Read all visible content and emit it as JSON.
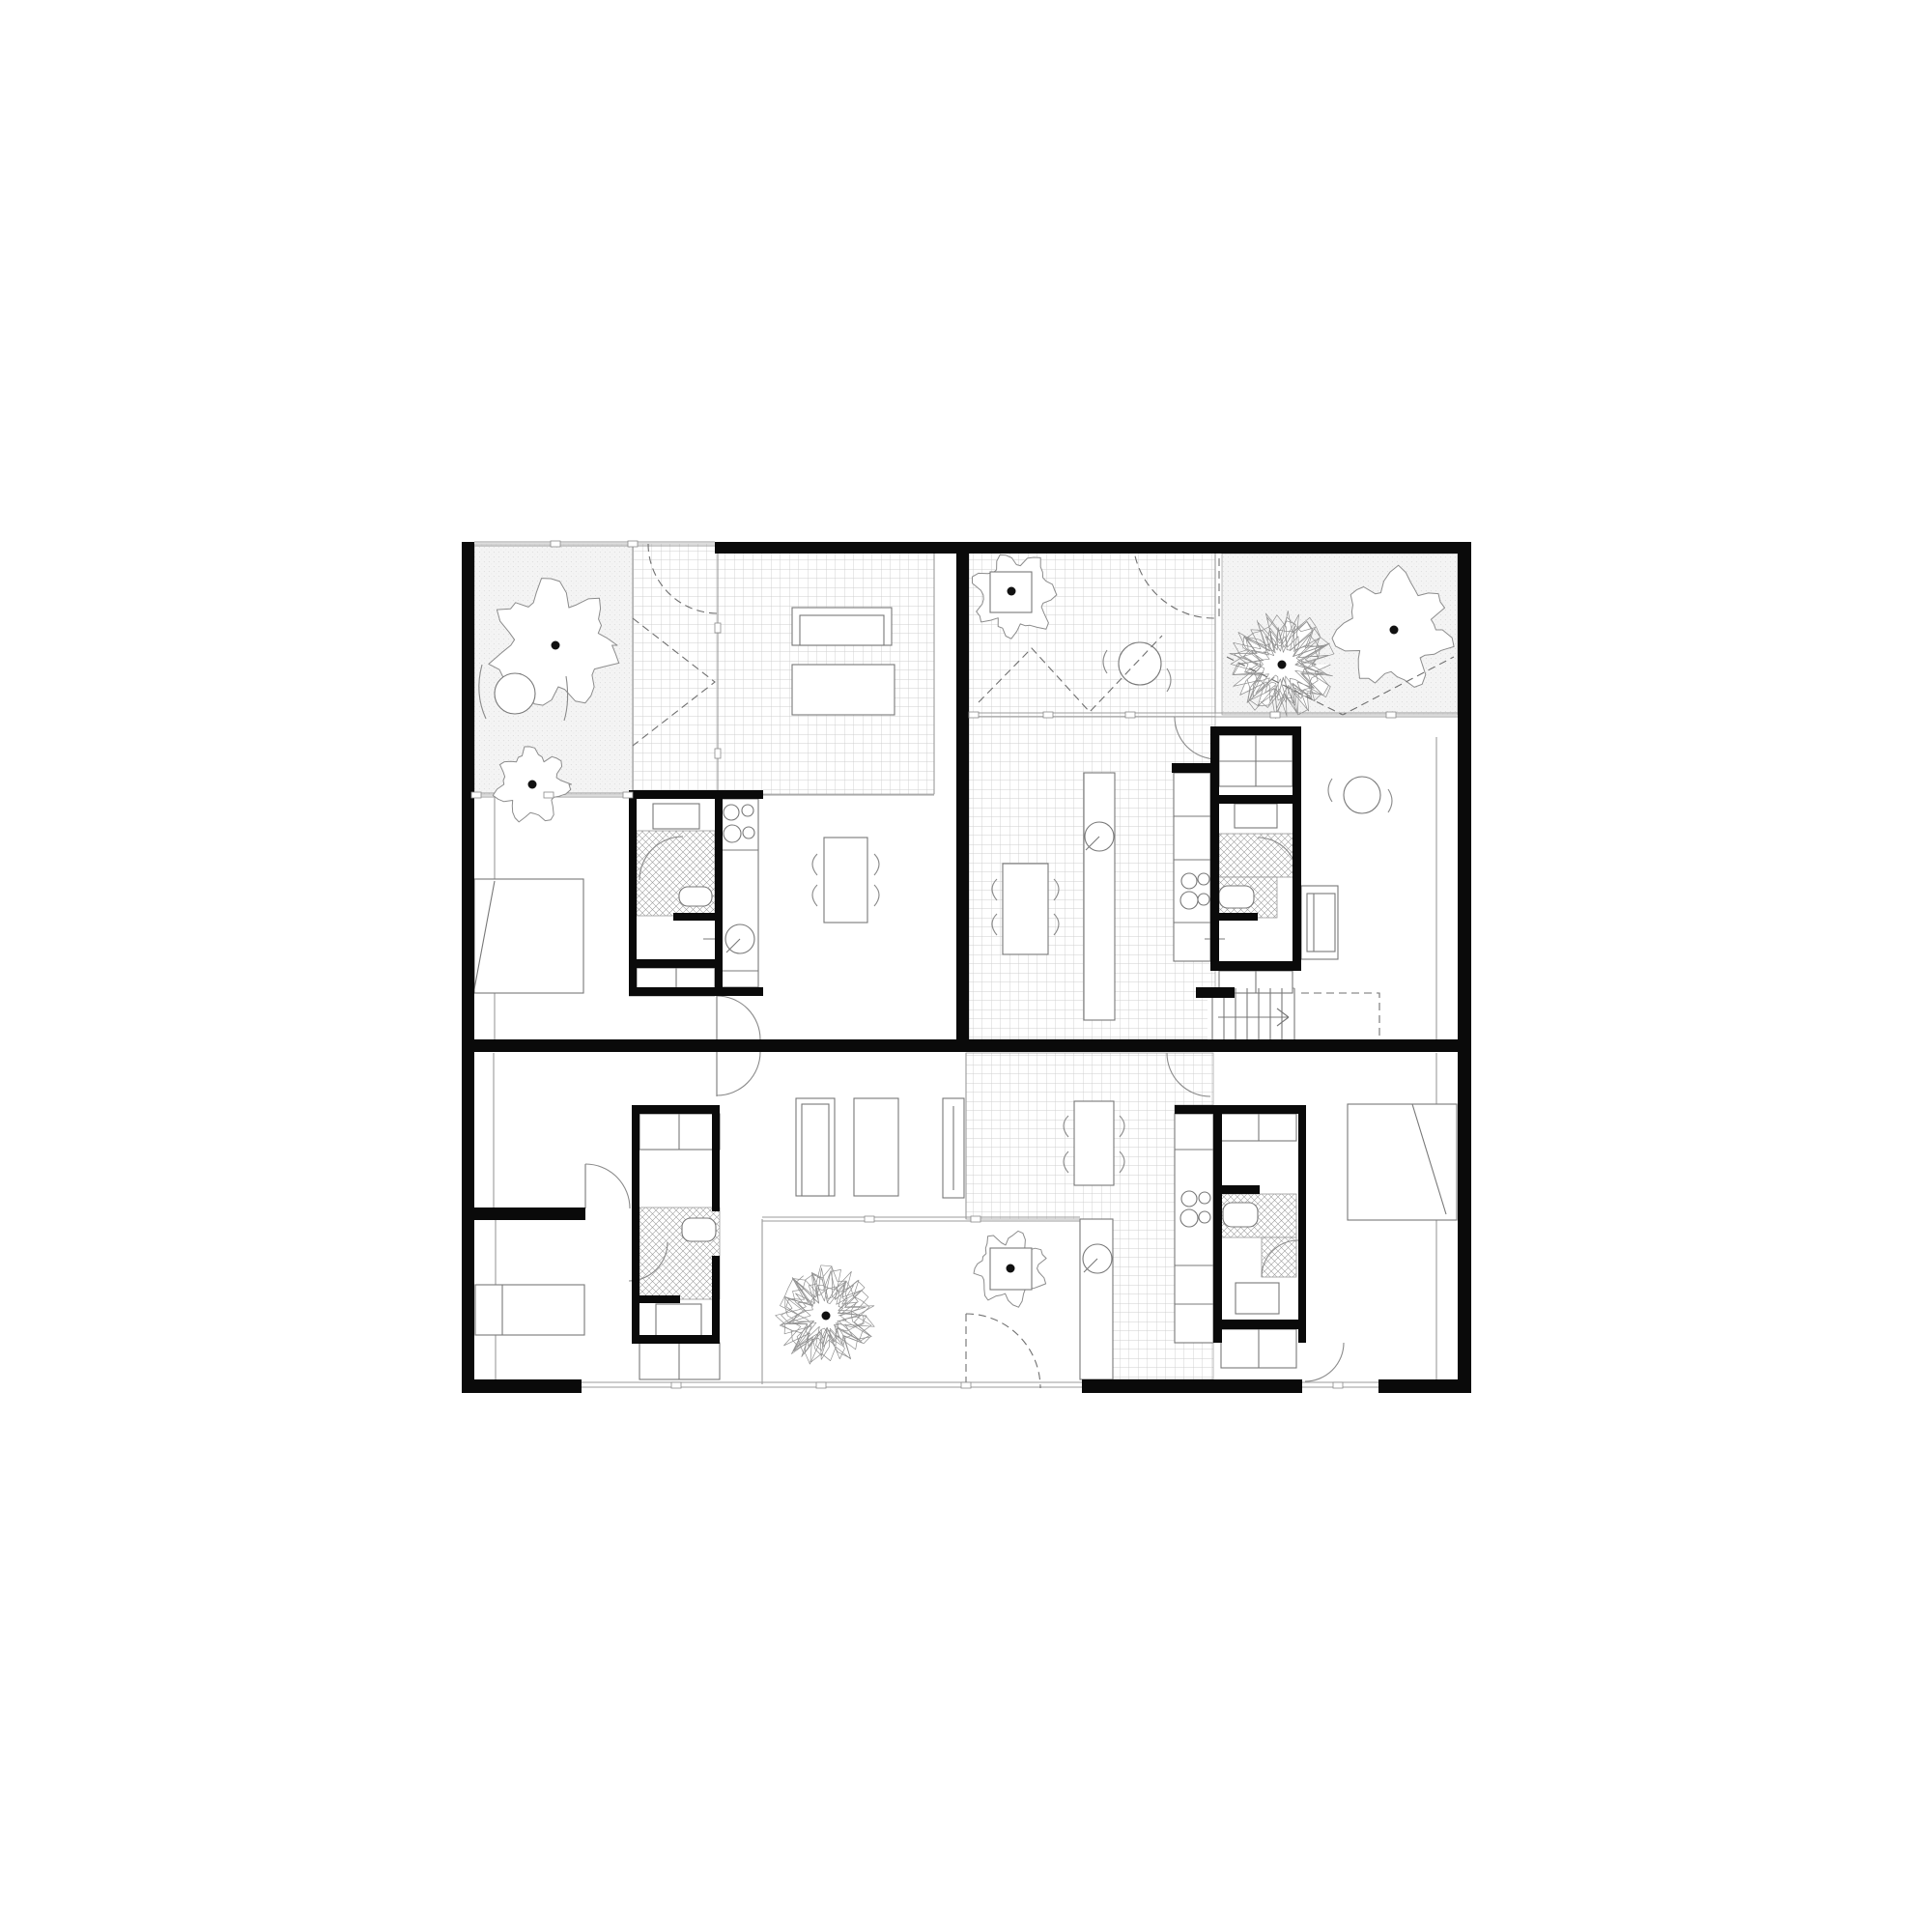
{
  "meta": {
    "title": "Residential floor plan — three dwelling units with walled gardens and patios",
    "canvas": 2000,
    "colors": {
      "wall": "#0a0a0a",
      "thin": "#787878",
      "pale": "#9b9b9b",
      "arc": "#8a8a8a",
      "dash": "#6f6f6f",
      "tileline": "#cfcfcf",
      "stipple_bg": "#f4f4f4",
      "stipple_dot": "#dcdcdc",
      "crosshatch": "#9a9a9a",
      "paper": "#ffffff",
      "treedot": "#111111"
    }
  },
  "plan": {
    "regions": [
      {
        "n": "garden-upper-left",
        "t": "stipple",
        "r": [
          491,
          563,
          164,
          260
        ]
      },
      {
        "n": "garden-upper-right",
        "t": "stipple",
        "r": [
          1265,
          573,
          244,
          167
        ]
      },
      {
        "n": "patio-upper-left",
        "t": "tile",
        "r": [
          655,
          563,
          88,
          260
        ]
      },
      {
        "n": "living-tile-upper-left",
        "t": "tile",
        "r": [
          743,
          569,
          224,
          253
        ]
      },
      {
        "n": "tile-upper-right",
        "t": "tile",
        "r": [
          1003,
          563,
          255,
          513
        ]
      },
      {
        "n": "tile-lower-unit",
        "t": "tile",
        "p": "1000,1090 1256,1090 1256,1144 1216,1144 1216,1390 1256,1390 1256,1428 1152,1428 1152,1262 1000,1262"
      }
    ],
    "covers": [
      {
        "n": "stair-floor",
        "r": [
          1250,
          1022,
          96,
          54
        ]
      }
    ],
    "pale": [
      [
        491,
        561,
        740,
        561
      ],
      [
        491,
        565,
        740,
        565
      ],
      [
        491,
        821,
        743,
        821
      ],
      [
        491,
        825,
        743,
        825
      ],
      [
        655,
        563,
        655,
        821
      ],
      [
        743,
        563,
        743,
        822
      ],
      [
        967,
        569,
        967,
        822
      ],
      [
        785,
        823,
        967,
        823
      ],
      [
        1003,
        738,
        1509,
        738
      ],
      [
        1003,
        742,
        1509,
        742
      ],
      [
        1258,
        563,
        1258,
        738
      ],
      [
        789,
        1260,
        1118,
        1260
      ],
      [
        789,
        1264,
        1118,
        1264
      ],
      [
        789,
        1262,
        789,
        1433
      ],
      [
        602,
        1431,
        1120,
        1431
      ],
      [
        602,
        1436,
        1120,
        1436
      ],
      [
        1348,
        1431,
        1427,
        1431
      ],
      [
        1348,
        1436,
        1427,
        1436
      ],
      [
        1000,
        1090,
        1000,
        1262
      ],
      [
        1487,
        763,
        1487,
        1076
      ],
      [
        1487,
        1090,
        1487,
        1428
      ],
      [
        512,
        823,
        512,
        1076
      ],
      [
        511,
        1090,
        511,
        1250
      ],
      [
        513,
        1263,
        513,
        1428
      ],
      [
        651,
        1031,
        740,
        1031
      ],
      [
        1255,
        1023,
        1340,
        1023
      ]
    ],
    "hatch": [
      {
        "n": "shower-ul",
        "r": [
          659,
          860,
          81,
          88
        ]
      },
      {
        "n": "shower-ur-a",
        "r": [
          1262,
          863,
          83,
          45
        ]
      },
      {
        "n": "shower-ur-b",
        "r": [
          1262,
          908,
          60,
          42
        ]
      },
      {
        "n": "shower-br-a",
        "r": [
          1264,
          1236,
          78,
          45
        ]
      },
      {
        "n": "shower-br-b",
        "r": [
          1306,
          1281,
          36,
          41
        ]
      },
      {
        "n": "shower-bl",
        "r": [
          662,
          1250,
          83,
          95
        ]
      }
    ],
    "trees": [
      {
        "n": "tree-big-upper-left",
        "c": [
          575,
          668
        ],
        "r": 66,
        "k": "f",
        "s": 7
      },
      {
        "n": "bush-upper-left",
        "c": [
          551,
          812
        ],
        "r": 40,
        "k": "f",
        "s": 13
      },
      {
        "n": "planter-tree-patio",
        "c": [
          1050,
          616
        ],
        "r": 44,
        "k": "f",
        "s": 21
      },
      {
        "n": "tree-garden-right",
        "c": [
          1443,
          652
        ],
        "r": 60,
        "k": "f",
        "s": 31
      },
      {
        "n": "tree-scribble-garden",
        "c": [
          1327,
          688
        ],
        "r": 62,
        "k": "s",
        "s": 41
      },
      {
        "n": "tree-scribble-courtyard",
        "c": [
          855,
          1362
        ],
        "r": 58,
        "k": "s",
        "s": 55
      },
      {
        "n": "planter-tree-courtyard",
        "c": [
          1046,
          1313
        ],
        "r": 38,
        "k": "f",
        "s": 61
      }
    ],
    "furn": [
      {
        "n": "planter-box-patio",
        "r": [
          1025,
          592,
          43,
          42
        ]
      },
      {
        "n": "planter-box-courtyard",
        "r": [
          1025,
          1292,
          43,
          43
        ]
      },
      {
        "n": "sofa-ul",
        "r": [
          820,
          629,
          103,
          39
        ]
      },
      {
        "n": "sofa-ul-inner",
        "r": [
          828,
          637,
          87,
          31
        ]
      },
      {
        "n": "daybed-ul",
        "r": [
          820,
          688,
          106,
          52
        ]
      },
      {
        "n": "bed-upper-left",
        "r": [
          491,
          910,
          113,
          118
        ]
      },
      {
        "n": "bed-lower-left",
        "r": [
          492,
          1330,
          113,
          52
        ]
      },
      {
        "n": "bed-lower-right",
        "r": [
          1395,
          1143,
          113,
          120
        ]
      },
      {
        "n": "table-ul-dining",
        "r": [
          853,
          867,
          45,
          88
        ]
      },
      {
        "n": "table-ur-dining",
        "r": [
          1038,
          894,
          47,
          94
        ]
      },
      {
        "n": "table-bottom-dining",
        "r": [
          1112,
          1140,
          41,
          87
        ]
      },
      {
        "n": "kitchen-island-ur",
        "r": [
          1122,
          800,
          32,
          256
        ]
      },
      {
        "n": "kitchen-counter-ul",
        "r": [
          747,
          827,
          38,
          195
        ]
      },
      {
        "n": "kitchen-counter-ur",
        "r": [
          1215,
          800,
          38,
          195
        ]
      },
      {
        "n": "kitchen-counter-bottom",
        "r": [
          1216,
          1153,
          40,
          237
        ]
      },
      {
        "n": "basin-ul",
        "r": [
          676,
          832,
          48,
          26
        ]
      },
      {
        "n": "toilet-ul",
        "r": [
          703,
          918,
          34,
          20,
          9
        ]
      },
      {
        "n": "wardrobe-ul",
        "r": [
          659,
          1002,
          81,
          23
        ]
      },
      {
        "n": "wardrobe-ur-top",
        "r": [
          1262,
          761,
          76,
          53
        ]
      },
      {
        "n": "basin-ur",
        "r": [
          1278,
          832,
          44,
          25
        ]
      },
      {
        "n": "toilet-ur",
        "r": [
          1262,
          917,
          36,
          23,
          9
        ]
      },
      {
        "n": "wardrobe-ur-bottom",
        "r": [
          1262,
          1005,
          76,
          23
        ]
      },
      {
        "n": "sofa-ur",
        "r": [
          1347,
          917,
          38,
          76
        ]
      },
      {
        "n": "sofa-ur-inner",
        "r": [
          1353,
          925,
          29,
          60
        ]
      },
      {
        "n": "wardrobe-br-top",
        "r": [
          1264,
          1153,
          78,
          28
        ]
      },
      {
        "n": "toilet-br",
        "r": [
          1266,
          1245,
          36,
          25,
          9
        ]
      },
      {
        "n": "basin-br",
        "r": [
          1279,
          1328,
          45,
          32
        ]
      },
      {
        "n": "wardrobe-br-bottom",
        "r": [
          1264,
          1376,
          78,
          40
        ]
      },
      {
        "n": "wardrobe-bl-top",
        "r": [
          662,
          1153,
          83,
          37
        ]
      },
      {
        "n": "toilet-bl",
        "r": [
          706,
          1261,
          35,
          24,
          9
        ]
      },
      {
        "n": "basin-bl",
        "r": [
          679,
          1350,
          47,
          35
        ]
      },
      {
        "n": "wardrobe-bl-bottom",
        "r": [
          662,
          1390,
          83,
          38
        ]
      },
      {
        "n": "bench-courtyard",
        "r": [
          1118,
          1262,
          34,
          166
        ]
      },
      {
        "n": "sofa-hall-1",
        "r": [
          824,
          1137,
          40,
          101
        ]
      },
      {
        "n": "sofa-hall-1-inner",
        "r": [
          830,
          1143,
          28,
          95
        ]
      },
      {
        "n": "sofa-hall-2",
        "r": [
          884,
          1137,
          46,
          101
        ]
      },
      {
        "n": "shelf-hall",
        "r": [
          976,
          1137,
          22,
          103
        ]
      }
    ],
    "circles": [
      [
        757,
        841,
        8
      ],
      [
        774,
        839,
        6
      ],
      [
        758,
        863,
        9
      ],
      [
        775,
        862,
        6
      ],
      [
        1231,
        912,
        8
      ],
      [
        1246,
        910,
        6
      ],
      [
        1231,
        932,
        9
      ],
      [
        1246,
        931,
        6
      ],
      [
        1231,
        1241,
        8
      ],
      [
        1247,
        1240,
        6
      ],
      [
        1231,
        1261,
        9
      ],
      [
        1247,
        1260,
        6
      ],
      [
        766,
        972,
        15
      ],
      [
        1138,
        866,
        15
      ],
      [
        1136,
        1303,
        15
      ],
      [
        1180,
        687,
        22
      ],
      [
        1410,
        823,
        19
      ],
      [
        533,
        718,
        21
      ]
    ],
    "lines": [
      [
        700,
        1002,
        700,
        1025
      ],
      [
        520,
        1330,
        520,
        1382
      ],
      [
        512,
        912,
        491,
        1024
      ],
      [
        1462,
        1143,
        1497,
        1257
      ],
      [
        987,
        1145,
        987,
        1232
      ],
      [
        1360,
        925,
        1360,
        985
      ],
      [
        747,
        880,
        785,
        880
      ],
      [
        747,
        1005,
        785,
        1005
      ],
      [
        1215,
        845,
        1253,
        845
      ],
      [
        1215,
        890,
        1253,
        890
      ],
      [
        1215,
        955,
        1253,
        955
      ],
      [
        1216,
        1190,
        1256,
        1190
      ],
      [
        1216,
        1310,
        1256,
        1310
      ],
      [
        1216,
        1350,
        1256,
        1350
      ],
      [
        1300,
        761,
        1300,
        814
      ],
      [
        1262,
        788,
        1338,
        788
      ],
      [
        1300,
        1005,
        1300,
        1028
      ],
      [
        1303,
        1153,
        1303,
        1181
      ],
      [
        1303,
        1376,
        1303,
        1416
      ],
      [
        703,
        1153,
        703,
        1190
      ],
      [
        703,
        1390,
        703,
        1428
      ],
      [
        606,
        1205,
        606,
        1251
      ],
      [
        742,
        1031,
        742,
        1076
      ],
      [
        742,
        1089,
        742,
        1135
      ],
      [
        728,
        972,
        747,
        972
      ],
      [
        1247,
        972,
        1268,
        972
      ],
      [
        752,
        986,
        766,
        972
      ],
      [
        1124,
        880,
        1138,
        866
      ],
      [
        1122,
        1317,
        1136,
        1303
      ],
      [
        1255,
        1023,
        1255,
        1076
      ],
      [
        1267,
        1023,
        1267,
        1076
      ],
      [
        1279,
        1023,
        1279,
        1076
      ],
      [
        1291,
        1023,
        1291,
        1076
      ],
      [
        1303,
        1023,
        1303,
        1076
      ],
      [
        1315,
        1023,
        1315,
        1076
      ],
      [
        1327,
        1023,
        1327,
        1076
      ],
      [
        1340,
        1023,
        1340,
        1076
      ],
      [
        1261,
        1053,
        1333,
        1053
      ],
      [
        1322,
        1044,
        1334,
        1053
      ],
      [
        1322,
        1062,
        1334,
        1053
      ]
    ],
    "arcs": [
      "M742,1031 A45,45 0 0 1 787,1076",
      "M787,1089 A45,45 0 0 1 742,1134",
      "M606,1205 A46,46 0 0 1 652,1251",
      "M1208,1090 A45,45 0 0 0 1253,1135",
      "M662,911 A45,45 0 0 1 707,866",
      "M1302,867 A41,41 0 0 1 1343,908",
      "M1306,1322 A38,38 0 0 1 1344,1284",
      "M651,1326 A40,40 0 0 0 691,1286",
      "M1391,1390 A40,40 0 0 1 1351,1430",
      "M1216,742 A44,44 0 0 0 1260,786",
      "M846,884 q-10,10 0,22",
      "M846,916 q-10,10 0,22",
      "M905,884 q10,10 0,22",
      "M905,916 q10,10 0,22",
      "M1032,910 q-10,10 0,22",
      "M1032,946 q-10,10 0,22",
      "M1091,910 q10,10 0,22",
      "M1091,946 q10,10 0,22",
      "M1146,673 q-8,12 0,24",
      "M1208,692 q8,12 0,24",
      "M1379,806 q-8,12 0,24",
      "M1437,817 q8,12 0,24",
      "M1106,1155 q-10,10 0,22",
      "M1106,1192 q-10,10 0,22",
      "M1159,1155 q10,10 0,22",
      "M1159,1192 q10,10 0,22",
      "M499,688 q-8,30 4,56",
      "M586,700 q4,26 -2,46"
    ],
    "dashed": [
      "M671,563 A72,72 0 0 0 743,635",
      "M1173,563 A84,84 0 0 0 1257,640",
      "M1262,565 L1262,642",
      "M655,640 L740,706 L655,772",
      "M1013,727 L1068,671 L1128,737 L1203,658",
      "M1270,680 L1390,740 L1505,680",
      "M1347,1028 L1428,1028 L1428,1076",
      "M1000,1360 L1000,1437",
      "M1000,1360 A77,77 0 0 1 1077,1437"
    ],
    "walls": [
      [
        478,
        561,
        13,
        881
      ],
      [
        1509,
        561,
        14,
        881
      ],
      [
        740,
        561,
        783,
        12
      ],
      [
        478,
        1076,
        1045,
        13
      ],
      [
        990,
        561,
        13,
        515
      ],
      [
        478,
        1428,
        124,
        14
      ],
      [
        1120,
        1428,
        228,
        14
      ],
      [
        1427,
        1428,
        96,
        14
      ],
      [
        651,
        818,
        139,
        9
      ],
      [
        651,
        827,
        8,
        196
      ],
      [
        740,
        818,
        8,
        205
      ],
      [
        697,
        945,
        43,
        8
      ],
      [
        651,
        993,
        89,
        9
      ],
      [
        651,
        1022,
        139,
        9
      ],
      [
        1213,
        790,
        48,
        10
      ],
      [
        1253,
        752,
        94,
        9
      ],
      [
        1253,
        752,
        9,
        253
      ],
      [
        1338,
        752,
        9,
        253
      ],
      [
        1257,
        823,
        81,
        9
      ],
      [
        1258,
        945,
        44,
        8
      ],
      [
        1253,
        995,
        94,
        10
      ],
      [
        1238,
        1022,
        40,
        11
      ],
      [
        1216,
        1144,
        135,
        9
      ],
      [
        1256,
        1153,
        9,
        237
      ],
      [
        1344,
        1144,
        8,
        246
      ],
      [
        1264,
        1227,
        40,
        9
      ],
      [
        1256,
        1366,
        96,
        10
      ],
      [
        654,
        1144,
        91,
        9
      ],
      [
        654,
        1153,
        8,
        237
      ],
      [
        737,
        1144,
        8,
        110
      ],
      [
        737,
        1300,
        8,
        90
      ],
      [
        654,
        1341,
        50,
        8
      ],
      [
        654,
        1382,
        91,
        9
      ],
      [
        478,
        1250,
        128,
        13
      ]
    ],
    "ticks": [
      [
        575,
        563,
        0
      ],
      [
        655,
        563,
        0
      ],
      [
        493,
        823,
        0
      ],
      [
        568,
        823,
        0
      ],
      [
        650,
        823,
        0
      ],
      [
        743,
        650,
        1
      ],
      [
        743,
        780,
        1
      ],
      [
        1008,
        740,
        0
      ],
      [
        1085,
        740,
        0
      ],
      [
        1170,
        740,
        0
      ],
      [
        1320,
        740,
        0
      ],
      [
        1440,
        740,
        0
      ],
      [
        900,
        1262,
        0
      ],
      [
        1010,
        1262,
        0
      ],
      [
        700,
        1434,
        0
      ],
      [
        850,
        1434,
        0
      ],
      [
        1000,
        1434,
        0
      ],
      [
        1385,
        1434,
        0
      ]
    ],
    "dots": [
      [
        575,
        668
      ],
      [
        551,
        812
      ],
      [
        1047,
        612
      ],
      [
        1443,
        652
      ],
      [
        1327,
        688
      ],
      [
        855,
        1362
      ],
      [
        1046,
        1313
      ]
    ]
  }
}
